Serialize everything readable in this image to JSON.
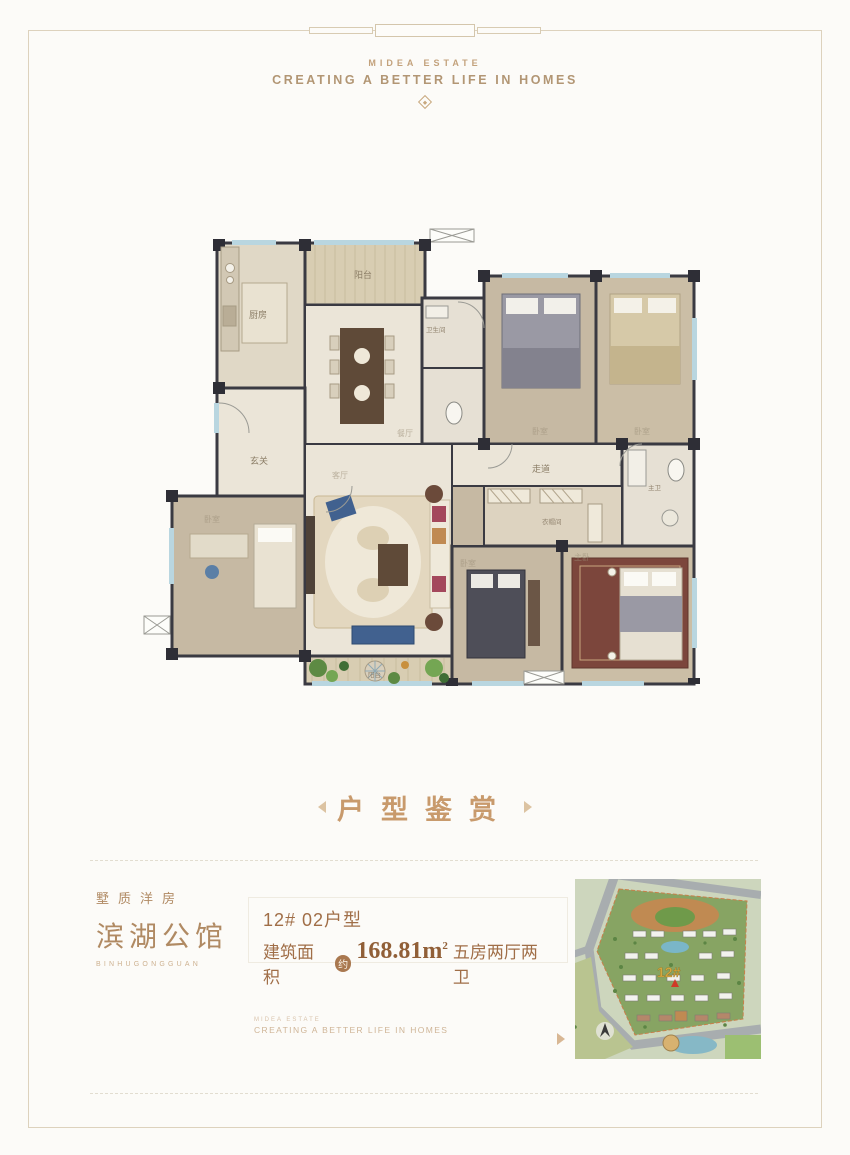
{
  "header": {
    "brand": "MIDEA ESTATE",
    "tagline": "CREATING A BETTER LIFE IN HOMES"
  },
  "floorplan": {
    "labels": {
      "kitchen": "厨房",
      "balcony_top": "阳台",
      "dining": "餐厅",
      "entry": "玄关",
      "bath": "卫生间",
      "bedroom_top_mid": "卧室",
      "bedroom_top_right": "卧室",
      "corridor": "走道",
      "master_bath": "主卫",
      "bedroom_left": "卧室",
      "living": "客厅",
      "bedroom_bottom_mid": "卧室",
      "cloakroom": "衣帽间",
      "master_bedroom": "主卧",
      "balcony_bottom": "阳台"
    }
  },
  "section_title": {
    "text": "户型鉴赏"
  },
  "footer": {
    "brand": {
      "subtitle": "墅质洋房",
      "title": "滨湖公馆",
      "pinyin": "BINHUGONGGUAN"
    },
    "info": {
      "unit": "12# 02户型",
      "area_label": "建筑面积",
      "approx": "约",
      "area_value": "168.81m",
      "area_sup": "2",
      "rooms": "五房两厅两卫"
    },
    "watermark": {
      "line1": "MIDEA ESTATE",
      "line2": "CREATING A BETTER LIFE IN HOMES"
    },
    "map": {
      "building": "12#"
    }
  },
  "colors": {
    "accent_gold": "#c89a6c",
    "text_brown": "#a06e47",
    "wall_dark": "#34343c",
    "window_blue": "#b9d6e0",
    "map_green": "#87a463",
    "marker_red": "#d03a28"
  }
}
